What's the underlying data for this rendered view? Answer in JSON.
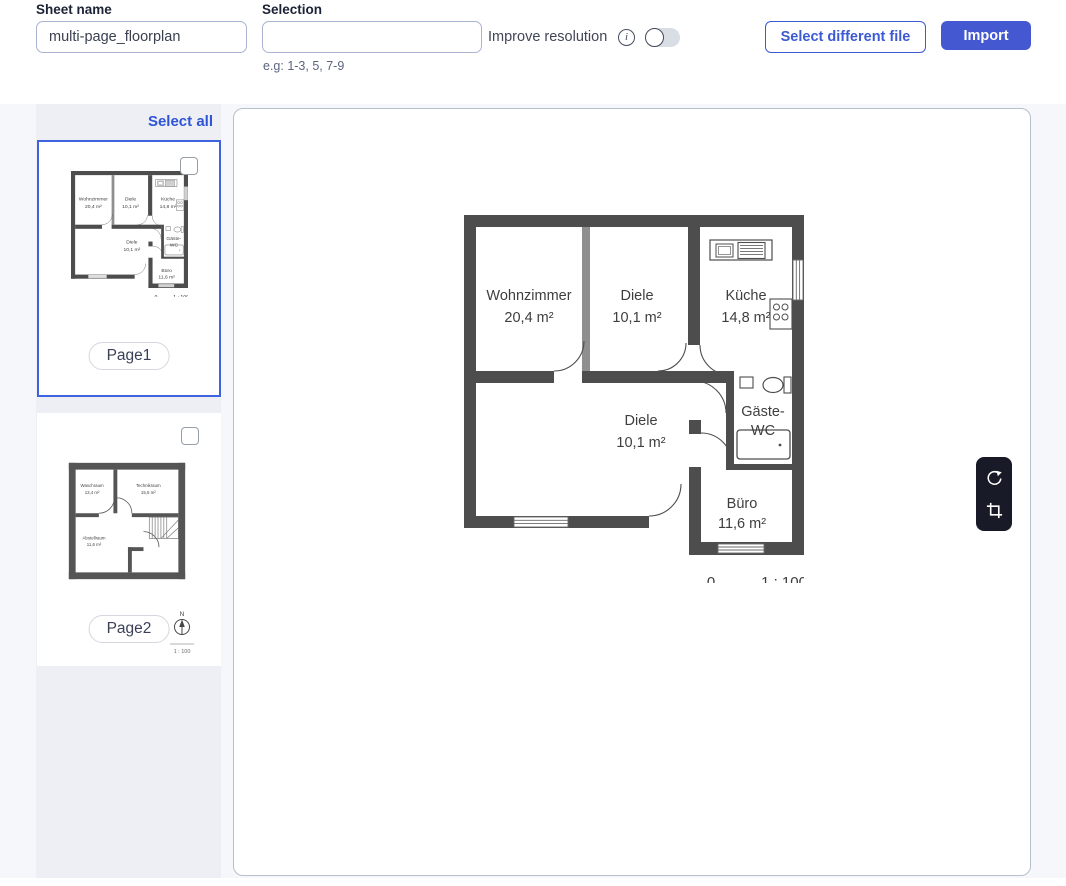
{
  "header": {
    "sheet_name_label": "Sheet name",
    "sheet_name_value": "multi-page_floorplan",
    "selection_label": "Selection",
    "selection_value": "",
    "selection_hint": "e.g: 1-3, 5, 7-9",
    "improve_resolution_label": "Improve resolution",
    "improve_resolution_enabled": false,
    "info_icon_glyph": "i",
    "select_different_file_label": "Select different file",
    "import_label": "Import"
  },
  "sidebar": {
    "select_all_label": "Select all",
    "pages": [
      {
        "label": "Page1",
        "selected": true,
        "checked": false
      },
      {
        "label": "Page2",
        "selected": false,
        "checked": false
      }
    ]
  },
  "floorplan_page1": {
    "rooms": {
      "wohnzimmer": {
        "name": "Wohnzimmer",
        "area": "20,4 m²"
      },
      "diele_top": {
        "name": "Diele",
        "area": "10,1 m²"
      },
      "kueche": {
        "name": "Küche",
        "area": "14,8 m²"
      },
      "diele_bottom": {
        "name": "Diele",
        "area": "10,1 m²"
      },
      "gaeste_wc": {
        "name_line1": "Gäste-",
        "name_line2": "WC"
      },
      "buero": {
        "name": "Büro",
        "area": "11,6 m²"
      }
    },
    "scale_zero": "0",
    "scale_ratio": "1 : 100"
  },
  "floorplan_page2": {
    "rooms": {
      "waschraum": {
        "name": "Waschraum",
        "area": "13,4 m²"
      },
      "technikraum": {
        "name": "Technikraum",
        "area": "15,5 m²"
      },
      "abstellraum": {
        "name": "Abstellraum",
        "area": "11,6 m²"
      }
    },
    "compass_label": "N",
    "scale_ratio": "1 : 100"
  },
  "toolbar": {
    "icons": [
      "rotate",
      "crop"
    ]
  },
  "colors": {
    "accent_blue": "#3c5ad4",
    "import_button_bg": "#4458d2",
    "selected_card_border": "#3d63de",
    "wall": "#4d4d4d",
    "toolbar_bg": "#181b27",
    "sidebar_bg": "#edeff4",
    "panel_border": "#b7bece"
  }
}
